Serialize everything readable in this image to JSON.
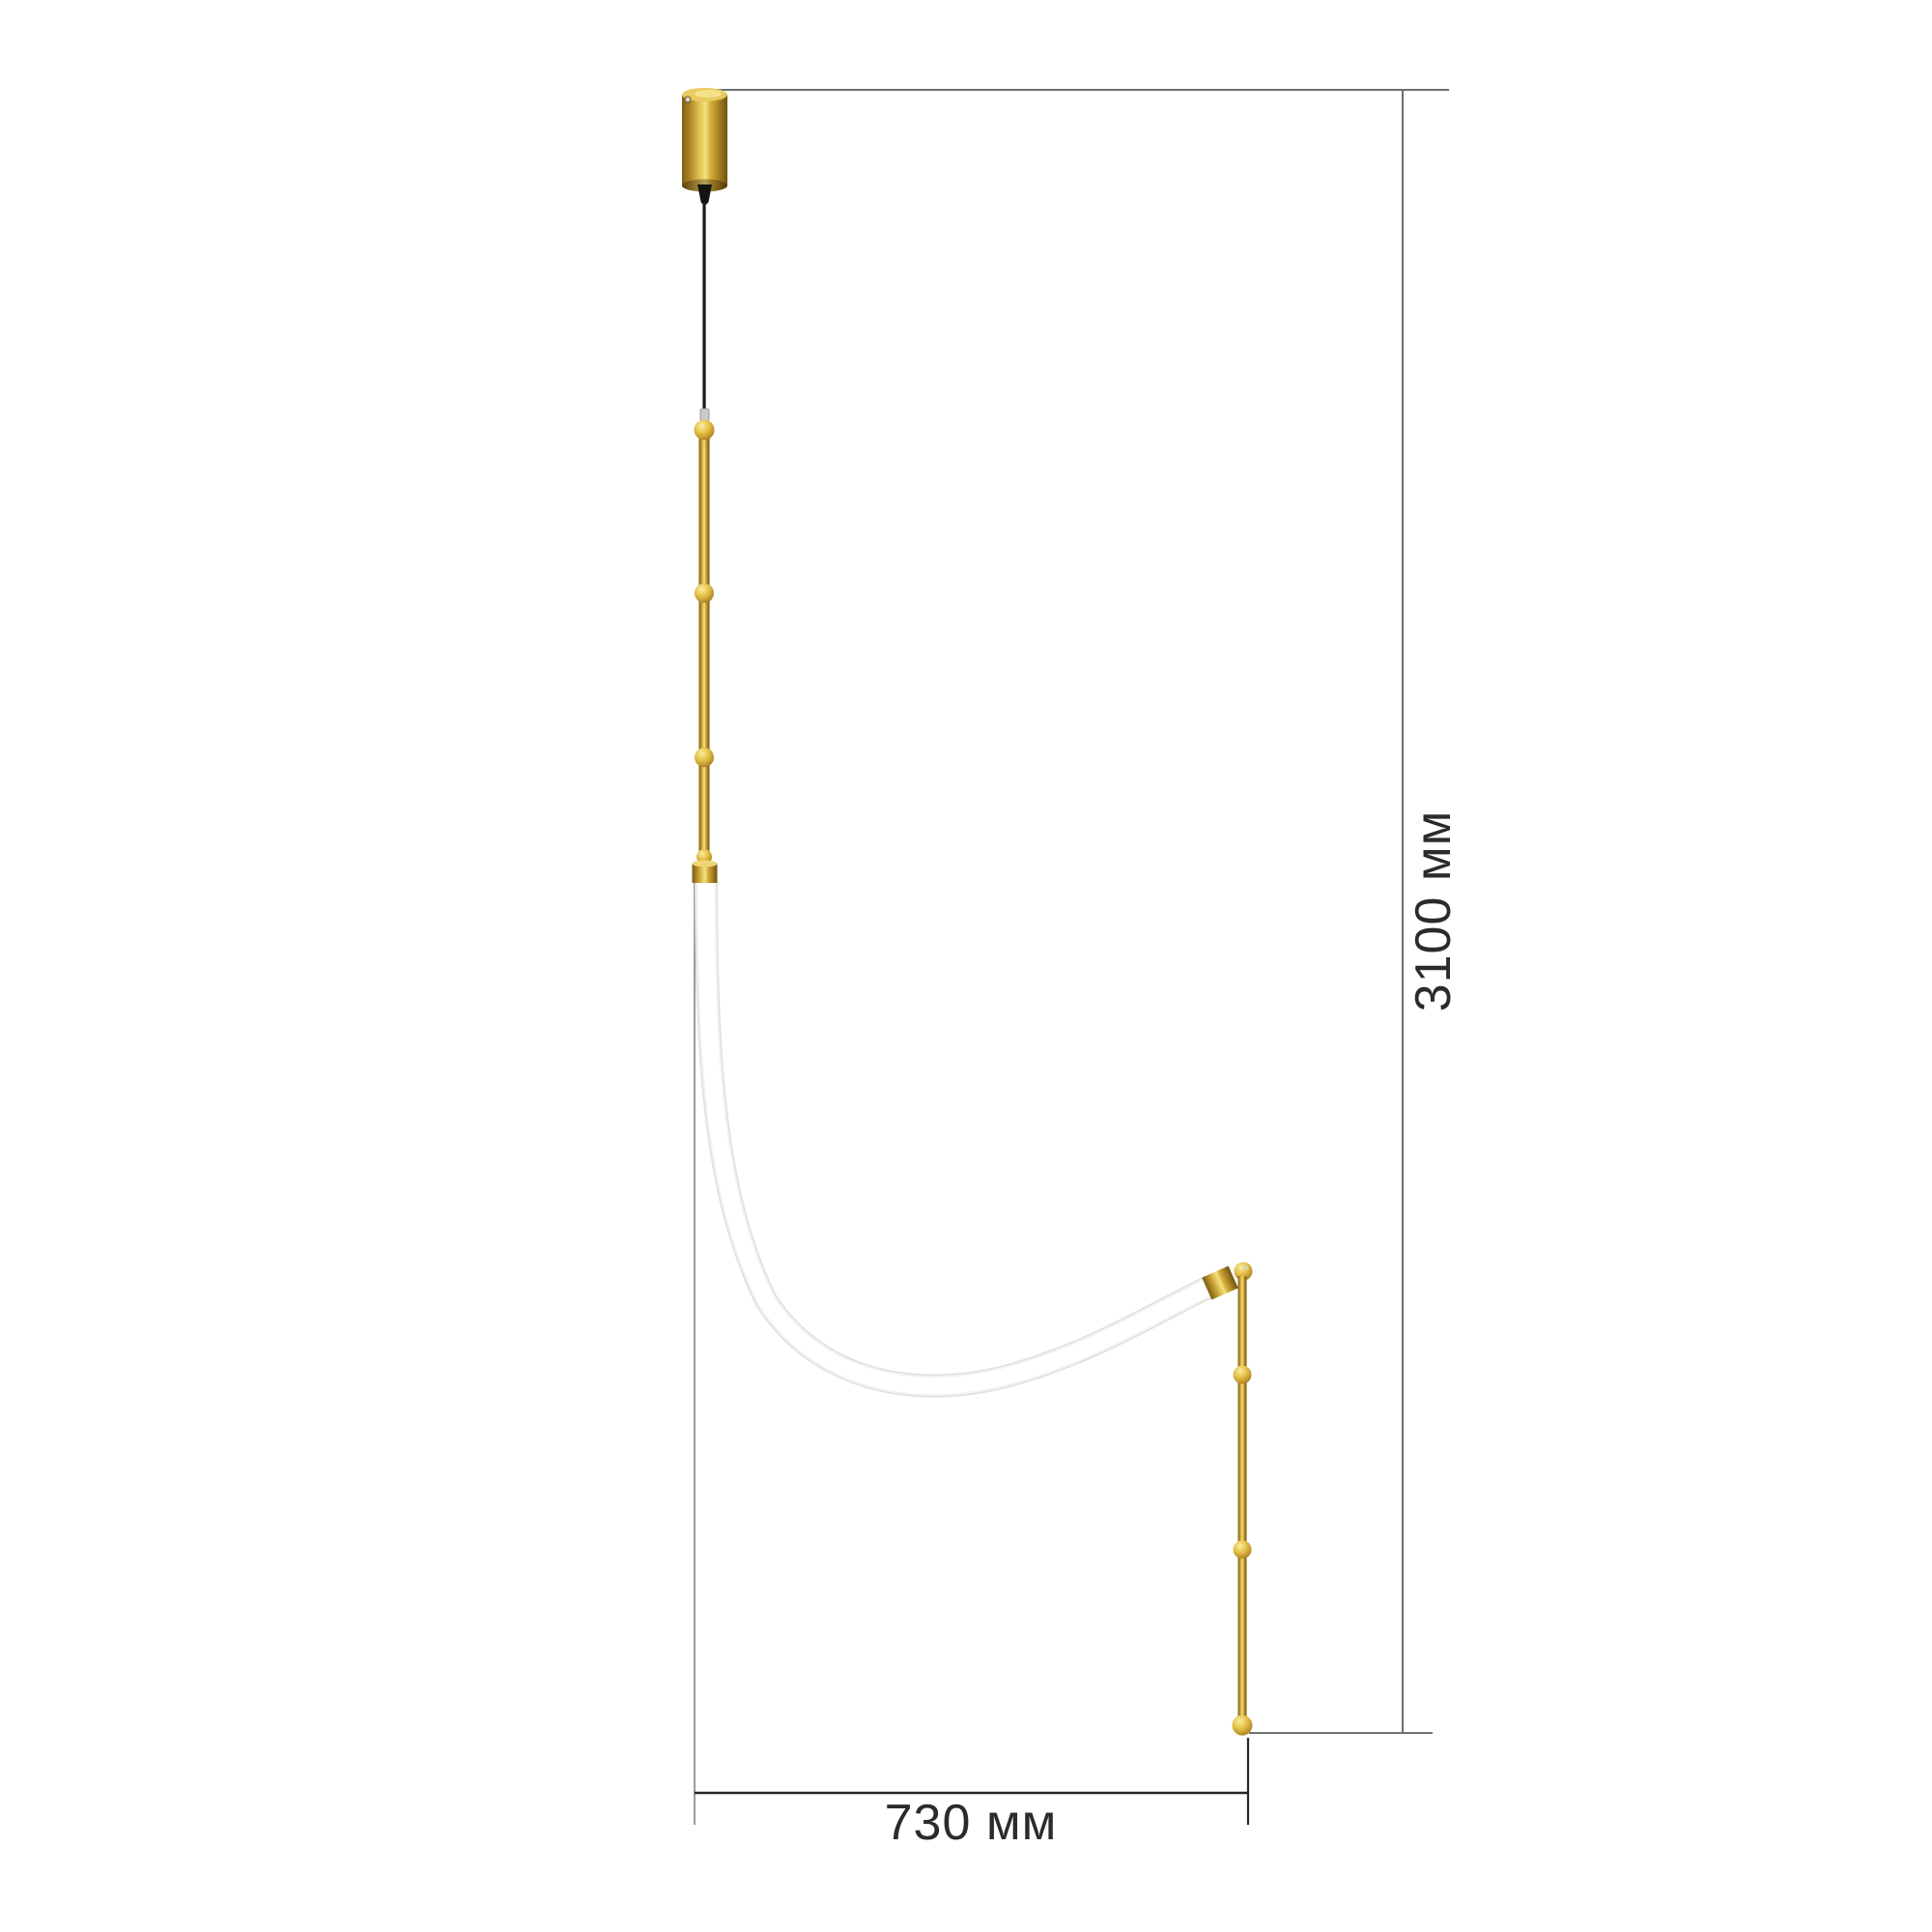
{
  "page": {
    "type": "product-dimension-drawing",
    "background_color": "#ffffff"
  },
  "dimensions_annotation": {
    "height": {
      "label": "3100 мм",
      "value": 3100,
      "unit": "мм",
      "orientation": "vertical"
    },
    "width": {
      "label": "730 мм",
      "value": 730,
      "unit": "мм",
      "orientation": "horizontal"
    },
    "text_color": "#2b2b2b",
    "line_color_gray": "#6f6f6f",
    "line_color_light": "#9a9a9a",
    "line_color_dark": "#262626"
  },
  "product": {
    "name": "pendant-light",
    "description": "brass pendant lamp with curved white LED flex tube, ceiling canopy, beaded rods",
    "colors": {
      "brass_highlight": "#f4df85",
      "brass_mid": "#d8b13a",
      "brass_dark": "#7d5e15",
      "tube_edge": "#e2dfda",
      "tube_core": "#f4f2ef",
      "tube_fill": "#ffffff",
      "cable_black": "#1d1b19",
      "canopy_top_face": "#e8ca60",
      "screw_silver": "#d8d3c4"
    },
    "parts": {
      "canopy": "ceiling canopy cylinder",
      "strain_relief": "black strain relief cone",
      "cable": "suspension cable",
      "upper_rod": "upper brass rod with 4 beads",
      "tube": "curved white LED tube",
      "elbow": "swivel elbow joint with ball",
      "lower_rod": "lower brass rod with 3 beads"
    }
  }
}
